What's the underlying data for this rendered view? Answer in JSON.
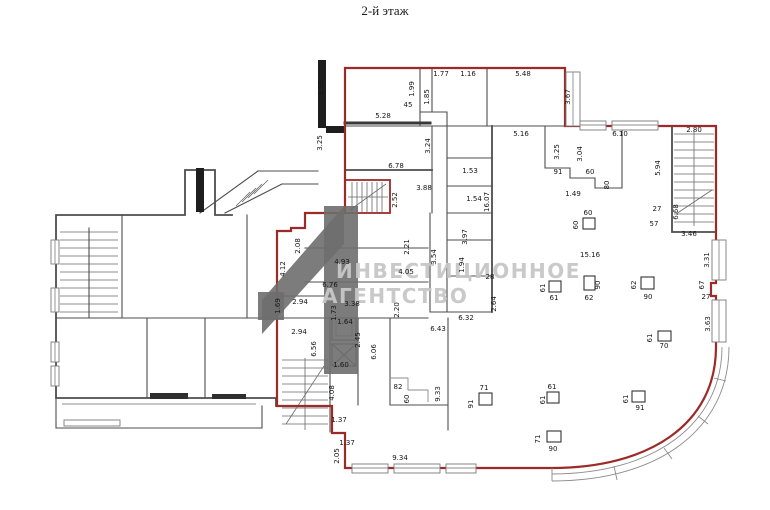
{
  "title": "2-й этаж",
  "watermark": {
    "line1": "ИНВЕСТИЦИОННОЕ",
    "line2": "АГЕНТСТВО"
  },
  "colors": {
    "outline": "#9c2b28",
    "wall": "#4d4d4d",
    "wallblack": "#1e1e1e",
    "label": "#161616",
    "wmtext": "#c7c7c7",
    "wmlogo": "#6e6e6e",
    "bg": "#ffffff"
  },
  "plan": {
    "dimension_labels": [
      {
        "t": "3.36",
        "x": 323,
        "y": 88,
        "r": -90
      },
      {
        "t": "1.99",
        "x": 414,
        "y": 89,
        "r": -90
      },
      {
        "t": "1.85",
        "x": 429,
        "y": 97,
        "r": -90
      },
      {
        "t": "1.77",
        "x": 441,
        "y": 76
      },
      {
        "t": "1.16",
        "x": 468,
        "y": 76
      },
      {
        "t": "45",
        "x": 408,
        "y": 107
      },
      {
        "t": "5.28",
        "x": 383,
        "y": 118
      },
      {
        "t": "5.48",
        "x": 523,
        "y": 76
      },
      {
        "t": "3.67",
        "x": 570,
        "y": 97,
        "r": -90
      },
      {
        "t": "3.25",
        "x": 322,
        "y": 143,
        "r": -90
      },
      {
        "t": "3.24",
        "x": 430,
        "y": 146,
        "r": -90
      },
      {
        "t": "6.78",
        "x": 396,
        "y": 168
      },
      {
        "t": "5.16",
        "x": 521,
        "y": 136
      },
      {
        "t": "6.10",
        "x": 620,
        "y": 136
      },
      {
        "t": "3.25",
        "x": 559,
        "y": 152,
        "r": -90
      },
      {
        "t": "3.04",
        "x": 582,
        "y": 154,
        "r": -90
      },
      {
        "t": "91",
        "x": 558,
        "y": 174
      },
      {
        "t": "60",
        "x": 590,
        "y": 174
      },
      {
        "t": "80",
        "x": 609,
        "y": 185,
        "r": -90
      },
      {
        "t": "1.49",
        "x": 573,
        "y": 196
      },
      {
        "t": "2.80",
        "x": 694,
        "y": 132
      },
      {
        "t": "5.94",
        "x": 660,
        "y": 168,
        "r": -90
      },
      {
        "t": "27",
        "x": 657,
        "y": 211
      },
      {
        "t": "57",
        "x": 654,
        "y": 226
      },
      {
        "t": "6.68",
        "x": 678,
        "y": 212,
        "r": -90
      },
      {
        "t": "3.46",
        "x": 689,
        "y": 236
      },
      {
        "t": "3.31",
        "x": 709,
        "y": 260,
        "r": -90
      },
      {
        "t": "67",
        "x": 704,
        "y": 285,
        "r": -90
      },
      {
        "t": "27",
        "x": 706,
        "y": 299
      },
      {
        "t": "3.63",
        "x": 710,
        "y": 324,
        "r": -90
      },
      {
        "t": "3.88",
        "x": 424,
        "y": 190
      },
      {
        "t": "2.52",
        "x": 397,
        "y": 200,
        "r": -90
      },
      {
        "t": "1.53",
        "x": 470,
        "y": 173
      },
      {
        "t": "1.54",
        "x": 474,
        "y": 201
      },
      {
        "t": "16.07",
        "x": 489,
        "y": 202,
        "r": -90
      },
      {
        "t": "2.21",
        "x": 409,
        "y": 247,
        "r": -90
      },
      {
        "t": "3.97",
        "x": 467,
        "y": 237,
        "r": -90
      },
      {
        "t": "3.54",
        "x": 436,
        "y": 257,
        "r": -90
      },
      {
        "t": "1.94",
        "x": 464,
        "y": 265,
        "r": -90
      },
      {
        "t": "28",
        "x": 490,
        "y": 279
      },
      {
        "t": "2.64",
        "x": 496,
        "y": 304,
        "r": -90
      },
      {
        "t": "6.32",
        "x": 466,
        "y": 320
      },
      {
        "t": "6.43",
        "x": 438,
        "y": 331
      },
      {
        "t": "4.93",
        "x": 342,
        "y": 264
      },
      {
        "t": "4.05",
        "x": 406,
        "y": 274
      },
      {
        "t": "6.76",
        "x": 330,
        "y": 287
      },
      {
        "t": "2.08",
        "x": 300,
        "y": 246,
        "r": -90
      },
      {
        "t": "4.12",
        "x": 285,
        "y": 269,
        "r": -90
      },
      {
        "t": "1.69",
        "x": 280,
        "y": 306,
        "r": -90
      },
      {
        "t": "2.94",
        "x": 300,
        "y": 304
      },
      {
        "t": "3.38",
        "x": 352,
        "y": 306
      },
      {
        "t": "1.73",
        "x": 336,
        "y": 313,
        "r": -90
      },
      {
        "t": "2.20",
        "x": 399,
        "y": 310,
        "r": -90
      },
      {
        "t": "1.64",
        "x": 345,
        "y": 324
      },
      {
        "t": "2.94",
        "x": 299,
        "y": 334
      },
      {
        "t": "6.56",
        "x": 316,
        "y": 349,
        "r": -90
      },
      {
        "t": "2.45",
        "x": 360,
        "y": 340,
        "r": -90
      },
      {
        "t": "6.06",
        "x": 376,
        "y": 352,
        "r": -90
      },
      {
        "t": "1.60",
        "x": 341,
        "y": 367
      },
      {
        "t": "4.08",
        "x": 334,
        "y": 393,
        "r": -90
      },
      {
        "t": "82",
        "x": 398,
        "y": 389
      },
      {
        "t": "60",
        "x": 409,
        "y": 399,
        "r": -90
      },
      {
        "t": "9.33",
        "x": 440,
        "y": 394,
        "r": -90
      },
      {
        "t": "1.37",
        "x": 339,
        "y": 422
      },
      {
        "t": "1.37",
        "x": 347,
        "y": 445
      },
      {
        "t": "2.05",
        "x": 339,
        "y": 456,
        "r": -90
      },
      {
        "t": "9.34",
        "x": 400,
        "y": 460
      },
      {
        "t": "15.16",
        "x": 590,
        "y": 257
      },
      {
        "t": "60",
        "x": 588,
        "y": 215
      },
      {
        "t": "60",
        "x": 578,
        "y": 225,
        "r": -90
      },
      {
        "t": "61",
        "x": 545,
        "y": 288,
        "r": -90
      },
      {
        "t": "61",
        "x": 554,
        "y": 300
      },
      {
        "t": "90",
        "x": 600,
        "y": 285,
        "r": -90
      },
      {
        "t": "62",
        "x": 589,
        "y": 300
      },
      {
        "t": "62",
        "x": 636,
        "y": 285,
        "r": -90
      },
      {
        "t": "90",
        "x": 648,
        "y": 299
      },
      {
        "t": "61",
        "x": 652,
        "y": 338,
        "r": -90
      },
      {
        "t": "70",
        "x": 664,
        "y": 348
      },
      {
        "t": "71",
        "x": 484,
        "y": 390
      },
      {
        "t": "91",
        "x": 473,
        "y": 404,
        "r": -90
      },
      {
        "t": "61",
        "x": 552,
        "y": 389
      },
      {
        "t": "61",
        "x": 545,
        "y": 400,
        "r": -90
      },
      {
        "t": "71",
        "x": 540,
        "y": 439,
        "r": -90
      },
      {
        "t": "90",
        "x": 553,
        "y": 451
      },
      {
        "t": "61",
        "x": 628,
        "y": 399,
        "r": -90
      },
      {
        "t": "91",
        "x": 640,
        "y": 410
      }
    ],
    "columns": [
      {
        "x": 583,
        "y": 218,
        "w": 12,
        "h": 11
      },
      {
        "x": 549,
        "y": 281,
        "w": 12,
        "h": 11
      },
      {
        "x": 584,
        "y": 276,
        "w": 11,
        "h": 14
      },
      {
        "x": 641,
        "y": 277,
        "w": 13,
        "h": 12
      },
      {
        "x": 658,
        "y": 331,
        "w": 13,
        "h": 10
      },
      {
        "x": 479,
        "y": 393,
        "w": 13,
        "h": 12
      },
      {
        "x": 547,
        "y": 392,
        "w": 12,
        "h": 11
      },
      {
        "x": 547,
        "y": 431,
        "w": 14,
        "h": 11
      },
      {
        "x": 632,
        "y": 391,
        "w": 13,
        "h": 11
      }
    ]
  }
}
